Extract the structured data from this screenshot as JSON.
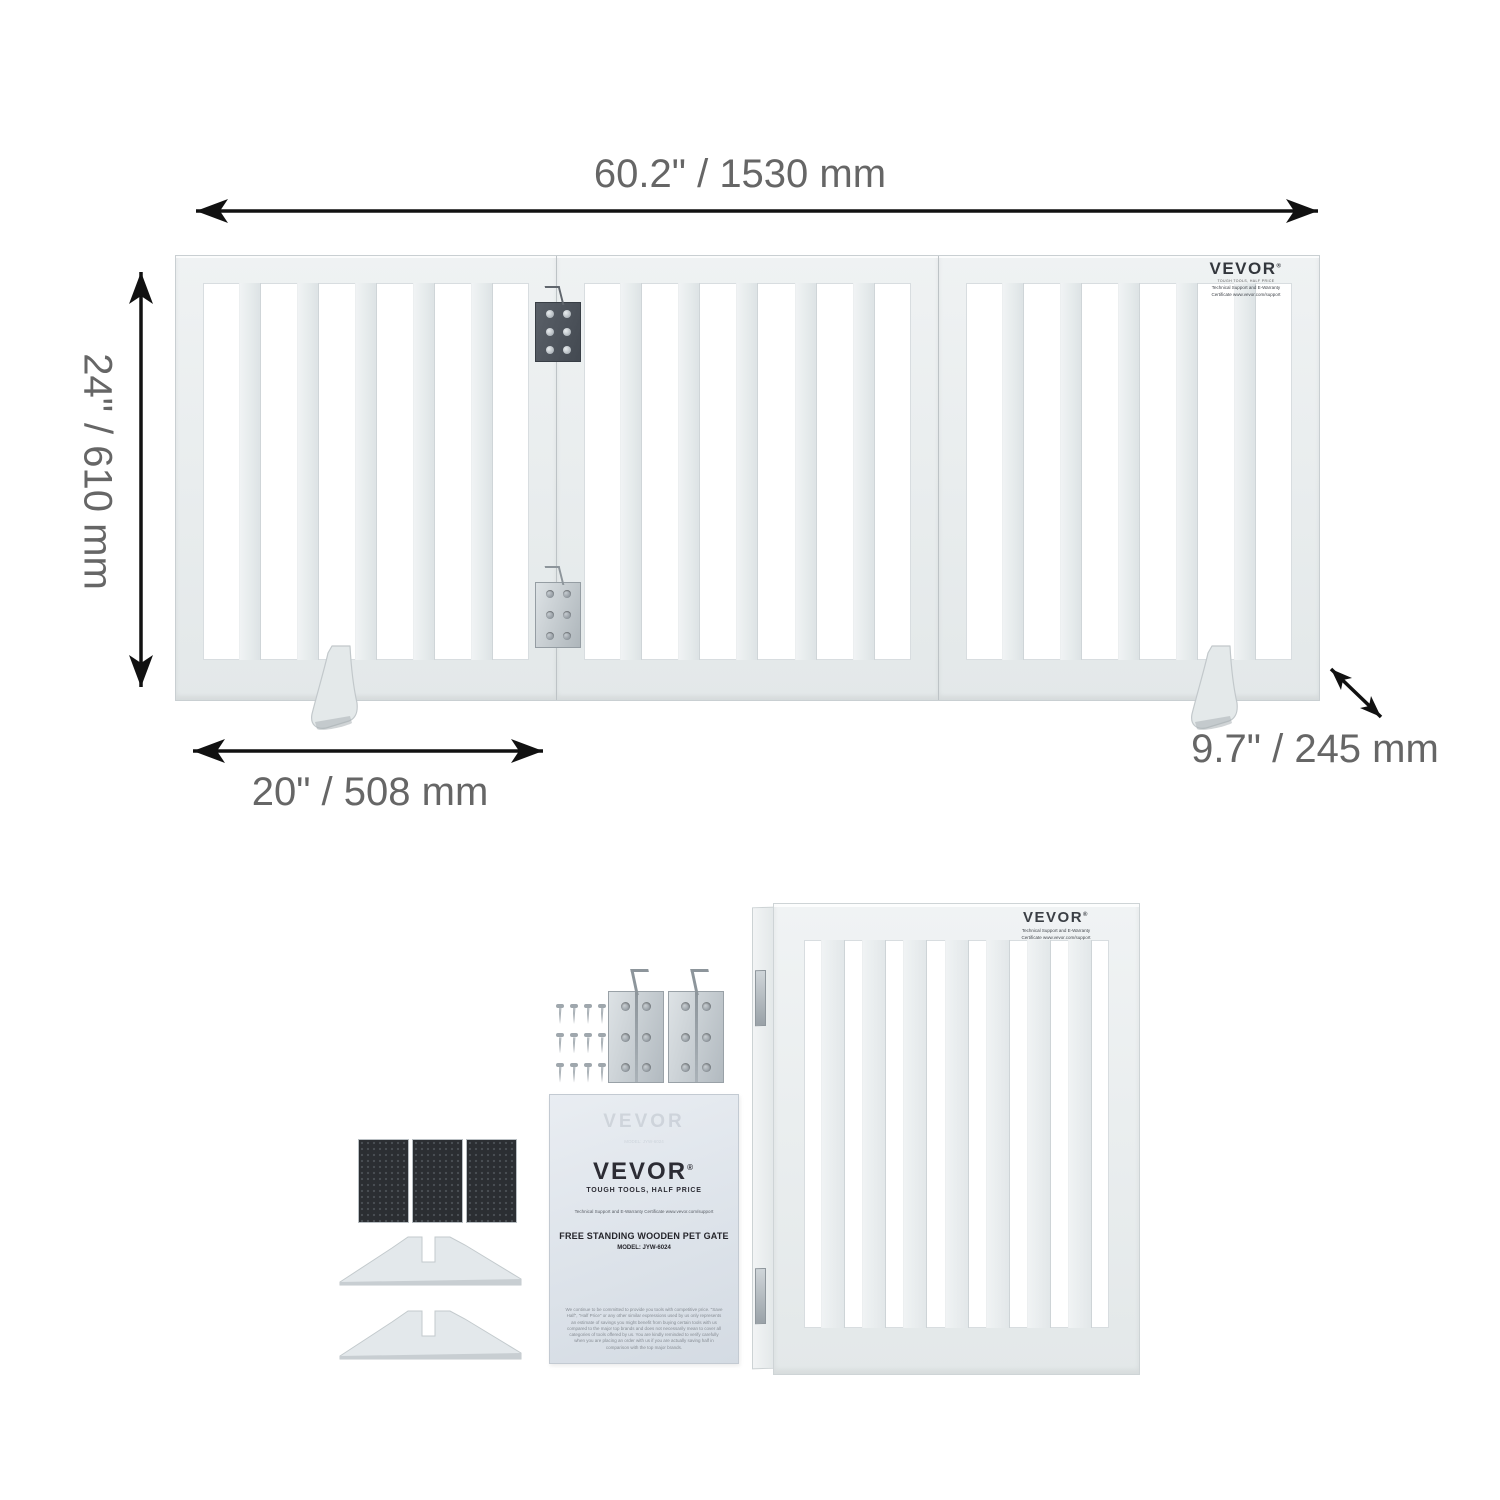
{
  "dimensions": {
    "width": "60.2\" / 1530 mm",
    "height": "24\" / 610 mm",
    "panel_width": "20\" / 508 mm",
    "depth": "9.7\" / 245 mm"
  },
  "brand": {
    "logo": "VEVOR",
    "reg": "®",
    "tagline": "TOUGH TOOLS, HALF PRICE",
    "support_line1": "Technical Support and E-Warranty",
    "support_line2": "Certificate www.vevor.com/support"
  },
  "gate": {
    "panels": 3,
    "slats_per_panel": 5
  },
  "parts": {
    "screws": 12,
    "hinges": 2,
    "anti_slip_pads": 3,
    "support_feet": 2
  },
  "manual": {
    "logo": "VEVOR",
    "reg": "®",
    "tagline": "TOUGH TOOLS, HALF PRICE",
    "support_line": "Technical Support and E-Warranty Certificate    www.vevor.com/support",
    "title": "FREE STANDING WOODEN PET GATE",
    "model": "MODEL: JYW-6024",
    "disclaimer": "We continue to be committed to provide you tools with competitive price. \"Save Half\", \"Half Price\" or any other similar expressions used by us only represents an estimate of savings you might benefit from buying certain tools with us compared to the major top brands and does not necessarily mean to cover all categories of tools offered by us. You are kindly reminded to verify carefully when you are placing an order with us if you are actually saving half in comparison with the top major brands."
  },
  "colors": {
    "background": "#ffffff",
    "gate_fill": "#e8eced",
    "gate_edge": "#c9cfd2",
    "dimension_text": "#666666",
    "arrow": "#111111",
    "hinge_dark": "#4e545c",
    "hinge_silver": "#c3cacf",
    "pad_black": "#2b2e32",
    "manual_paper": "#dde3ea",
    "logo_ink": "#2c2c34"
  }
}
